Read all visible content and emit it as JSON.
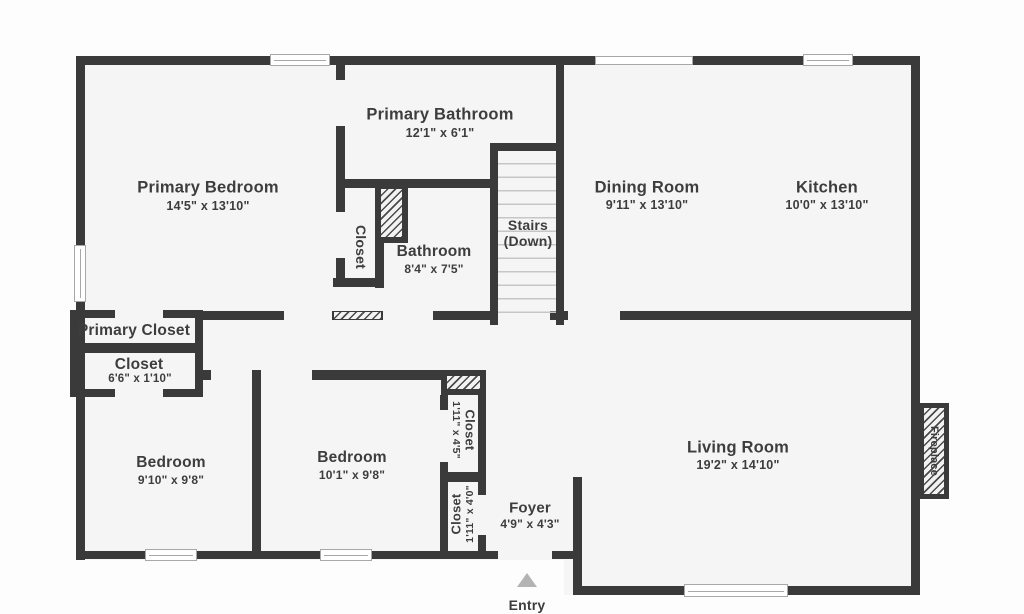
{
  "rooms": {
    "primary_bedroom": {
      "name": "Primary Bedroom",
      "dims": "14'5\" x 13'10\""
    },
    "primary_bathroom": {
      "name": "Primary Bathroom",
      "dims": "12'1\" x 6'1\""
    },
    "hall_closet": {
      "name": "Closet"
    },
    "bathroom": {
      "name": "Bathroom",
      "dims": "8'4\" x 7'5\""
    },
    "stairs": {
      "name": "Stairs",
      "sub": "(Down)"
    },
    "dining_room": {
      "name": "Dining Room",
      "dims": "9'11\" x 13'10\""
    },
    "kitchen": {
      "name": "Kitchen",
      "dims": "10'0\" x 13'10\""
    },
    "primary_closet": {
      "name": "Primary Closet"
    },
    "hall_closet_66": {
      "name": "Closet",
      "dims": "6'6\" x 1'10\""
    },
    "bedroom_1": {
      "name": "Bedroom",
      "dims": "9'10\" x 9'8\""
    },
    "bedroom_2": {
      "name": "Bedroom",
      "dims": "10'1\" x 9'8\""
    },
    "closet_45": {
      "name": "Closet",
      "dims": "1'11\" x 4'5\""
    },
    "closet_40": {
      "name": "Closet",
      "dims": "1'11\" x 4'0\""
    },
    "foyer": {
      "name": "Foyer",
      "dims": "4'9\" x 4'3\""
    },
    "living_room": {
      "name": "Living Room",
      "dims": "19'2\" x 14'10\""
    },
    "fireplace": {
      "name": "Fireplace"
    }
  },
  "entry": {
    "label": "Entry"
  },
  "colors": {
    "wall": "#3a3a3a",
    "room_fill": "#f5f5f5",
    "page_background": "#fdfdfd",
    "stair_tread": "#c6c6c6",
    "window_frame": "#a8a8a8",
    "entry_arrow": "#b3b3b3",
    "label_text": "#3d3d3d"
  }
}
